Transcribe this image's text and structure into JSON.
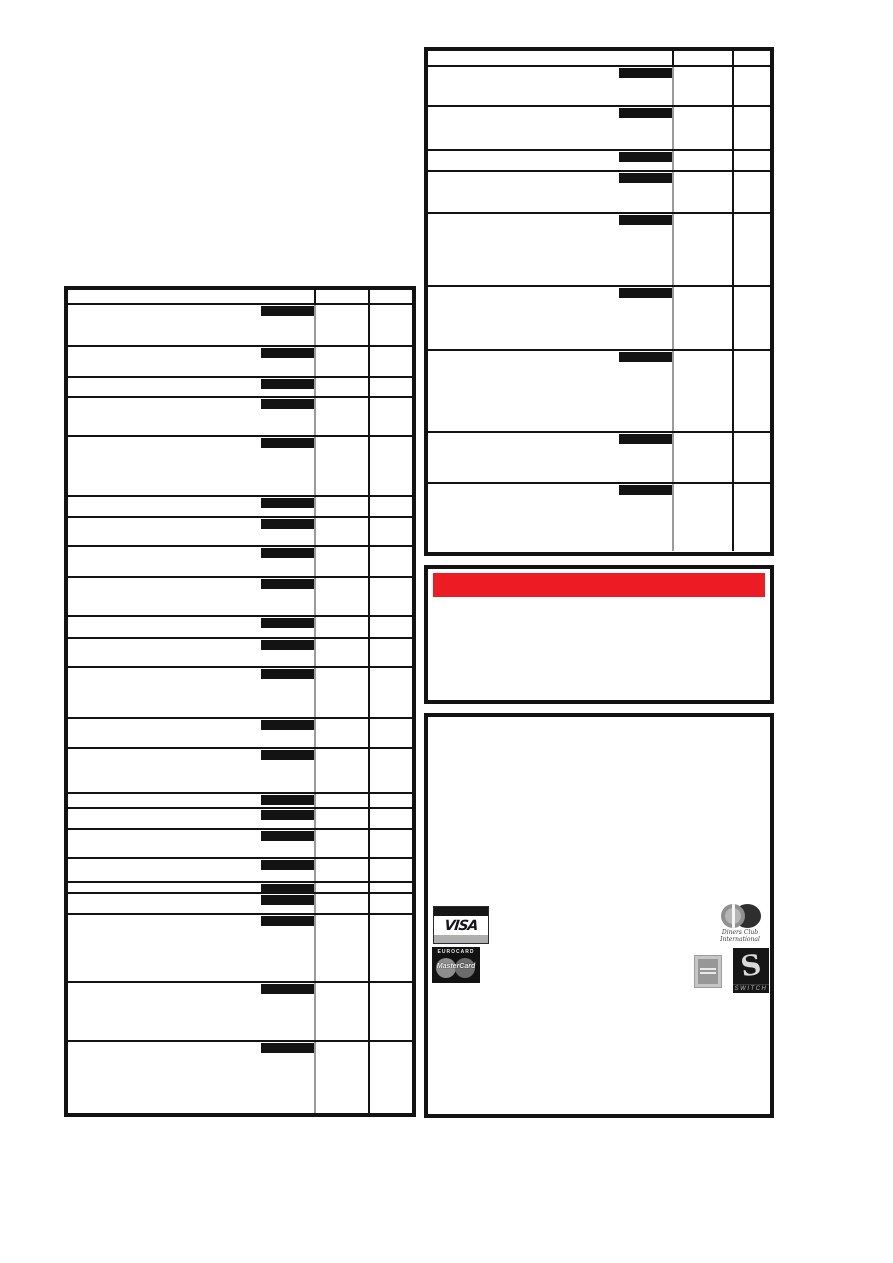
{
  "page": {
    "background": "#ffffff",
    "ink_color": "#131313",
    "divider_gray": "#9b9b9b"
  },
  "left_table": {
    "description": "price table with redacted entries, no visible text",
    "header_height": 13,
    "col2_width": 54,
    "col3_width": 42,
    "bar": {
      "width": 53,
      "height": 10,
      "color": "#131313"
    },
    "row_heights": [
      42,
      31,
      20,
      39,
      60,
      21,
      29,
      31,
      39,
      22,
      29,
      51,
      30,
      45,
      15,
      21,
      29,
      24,
      11,
      21,
      68,
      59,
      74
    ]
  },
  "right_table": {
    "description": "price table with redacted entries, no visible text",
    "header_height": 14,
    "col2_width": 60,
    "col3_width": 36,
    "bar": {
      "width": 53,
      "height": 10,
      "color": "#131313"
    },
    "row_heights": [
      40,
      44,
      21,
      42,
      73,
      64,
      82,
      51,
      69
    ]
  },
  "notice": {
    "banner_color": "#ED1C24"
  },
  "payment": {
    "visa": {
      "label": "VISA"
    },
    "eurocard_mastercard": {
      "top_label": "EUROCARD",
      "label": "MasterCard"
    },
    "diners": {
      "label_line1": "Diners Club",
      "label_line2": "International"
    },
    "switch": {
      "letter": "S",
      "label": "SWITCH"
    }
  }
}
